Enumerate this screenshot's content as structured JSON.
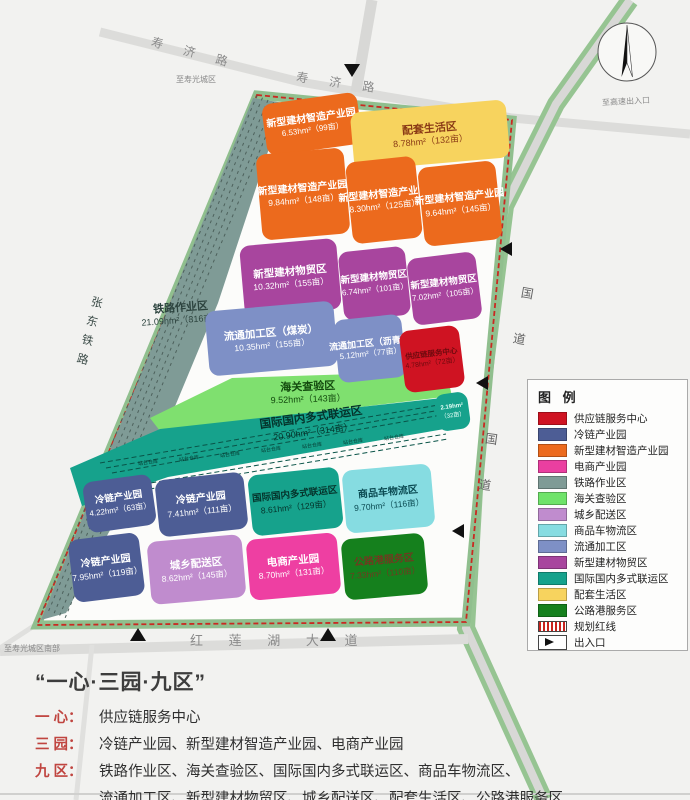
{
  "map": {
    "roads": {
      "shouji_road_1": "寿 济 路",
      "shouji_road_2": "寿 济 路",
      "guodao_1": "国 道",
      "guodao_2": "国 道",
      "honglianhu": "红 莲 湖 大 道",
      "zhangdong_railway": "张东铁路",
      "to_city_top": "至寿光城区",
      "to_highway": "至高速出入口",
      "to_city_south": "至寿光城区南部"
    },
    "warehouse_label": "站台仓库",
    "zones": [
      {
        "name": "新型建材智造产业园",
        "area": "6.53hm²（99亩）",
        "color": "#ec6a1d",
        "text": "#ffffff"
      },
      {
        "name": "配套生活区",
        "area": "8.78hm²（132亩）",
        "color": "#f7d35e",
        "text": "#8a3a16"
      },
      {
        "name": "新型建材智造产业园",
        "area": "9.84hm²（148亩）",
        "color": "#ec6a1d",
        "text": "#ffffff"
      },
      {
        "name": "新型建材智造产业园",
        "area": "8.30hm²（125亩）",
        "color": "#ec6a1d",
        "text": "#ffffff"
      },
      {
        "name": "新型建材智造产业园",
        "area": "9.64hm²（145亩）",
        "color": "#ec6a1d",
        "text": "#ffffff"
      },
      {
        "name": "新型建材物贸区",
        "area": "10.32hm²（155亩）",
        "color": "#a8459e",
        "text": "#ffffff"
      },
      {
        "name": "新型建材物贸区",
        "area": "6.74hm²（101亩）",
        "color": "#a8459e",
        "text": "#ffffff"
      },
      {
        "name": "新型建材物贸区",
        "area": "7.02hm²（105亩）",
        "color": "#a8459e",
        "text": "#ffffff"
      },
      {
        "name": "铁路作业区",
        "area": "21.09hm²（316亩）",
        "color": "transparent",
        "text": "#2c433e"
      },
      {
        "name": "流通加工区（煤炭）",
        "area": "10.35hm²（155亩）",
        "color": "#7e90c6",
        "text": "#ffffff"
      },
      {
        "name": "流通加工区（沥青）",
        "area": "5.12hm²（77亩）",
        "color": "#7e90c6",
        "text": "#ffffff"
      },
      {
        "name": "供应链服务中心",
        "area": "4.78hm²（72亩）",
        "color": "#cf1322",
        "text": "#6e0a0e"
      },
      {
        "name": "海关查验区",
        "area": "9.52hm²（143亩）",
        "color": "transparent",
        "text": "#134a0e"
      },
      {
        "name": "国际国内多式联运区",
        "area": "20.90hm²（314亩）",
        "color": "transparent",
        "text": "#05332b"
      },
      {
        "name": "2.19hm²",
        "area": "（32亩）",
        "color": "#16a28c",
        "text": "#e8fff8"
      },
      {
        "name": "冷链产业园",
        "area": "4.22hm²（63亩）",
        "color": "#4d5d95",
        "text": "#ffffff"
      },
      {
        "name": "冷链产业园",
        "area": "7.41hm²（111亩）",
        "color": "#4d5d95",
        "text": "#ffffff"
      },
      {
        "name": "国际国内多式联运区",
        "area": "8.61hm²（129亩）",
        "color": "#16a28c",
        "text": "#05332b"
      },
      {
        "name": "商品车物流区",
        "area": "9.70hm²（116亩）",
        "color": "#86dce1",
        "text": "#0a4a52"
      },
      {
        "name": "冷链产业园",
        "area": "7.95hm²（119亩）",
        "color": "#4d5d95",
        "text": "#ffffff"
      },
      {
        "name": "城乡配送区",
        "area": "8.62hm²（145亩）",
        "color": "#c08cce",
        "text": "#ffffff"
      },
      {
        "name": "电商产业园",
        "area": "8.70hm²（131亩）",
        "color": "#ee3fa2",
        "text": "#ffffff"
      },
      {
        "name": "公路港服务区",
        "area": "7.33hm²（110亩）",
        "color": "#15801d",
        "text": "#703a20"
      }
    ]
  },
  "legend": {
    "title": "图 例",
    "items": [
      {
        "label": "供应链服务中心",
        "color": "#cf1322"
      },
      {
        "label": "冷链产业园",
        "color": "#4d5d95"
      },
      {
        "label": "新型建材智造产业园",
        "color": "#ec6a1d"
      },
      {
        "label": "电商产业园",
        "color": "#ea3fa0"
      },
      {
        "label": "铁路作业区",
        "color": "#7f9b96"
      },
      {
        "label": "海关查验区",
        "color": "#6fe36a"
      },
      {
        "label": "城乡配送区",
        "color": "#c08cce"
      },
      {
        "label": "商品车物流区",
        "color": "#86dce1"
      },
      {
        "label": "流通加工区",
        "color": "#7e90c6"
      },
      {
        "label": "新型建材物贸区",
        "color": "#a8459e"
      },
      {
        "label": "国际国内多式联运区",
        "color": "#16a28c"
      },
      {
        "label": "配套生活区",
        "color": "#f7d35e"
      },
      {
        "label": "公路港服务区",
        "color": "#15801d"
      }
    ],
    "redline_label": "规划红线",
    "entrance_label": "出入口"
  },
  "footer": {
    "title": "“一心·三园·九区”",
    "lines": [
      {
        "label": "一 心：",
        "text": "供应链服务中心"
      },
      {
        "label": "三 园：",
        "text": "冷链产业园、新型建材智造产业园、电商产业园"
      },
      {
        "label": "九 区：",
        "text": "铁路作业区、海关查验区、国际国内多式联运区、商品车物流区、"
      },
      {
        "label": "",
        "text": "流通加工区、新型建材物贸区、城乡配送区、配套生活区、公路港服务区"
      }
    ]
  }
}
